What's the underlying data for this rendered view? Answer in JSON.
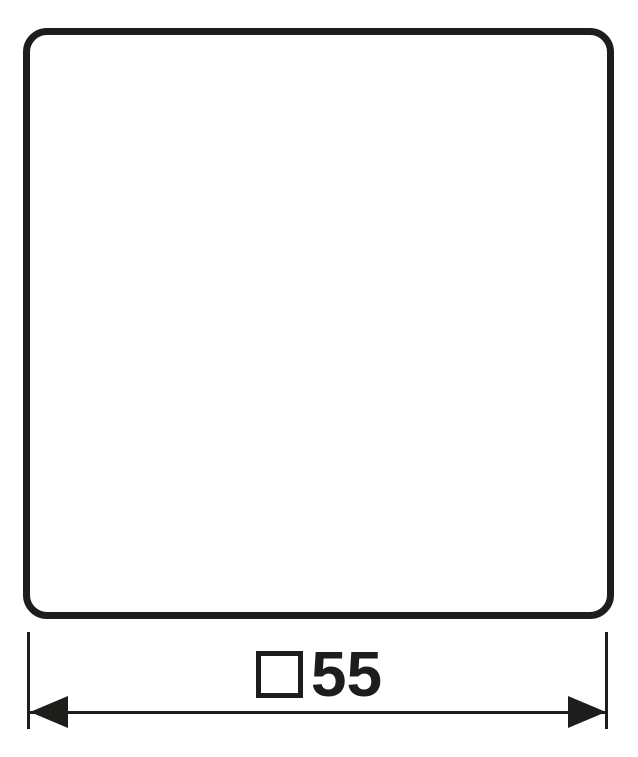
{
  "colors": {
    "ink": "#1d1d1b",
    "background": "#ffffff"
  },
  "drawing": {
    "dimension": {
      "symbol": "□",
      "value": "55",
      "full_label": "□55"
    }
  }
}
